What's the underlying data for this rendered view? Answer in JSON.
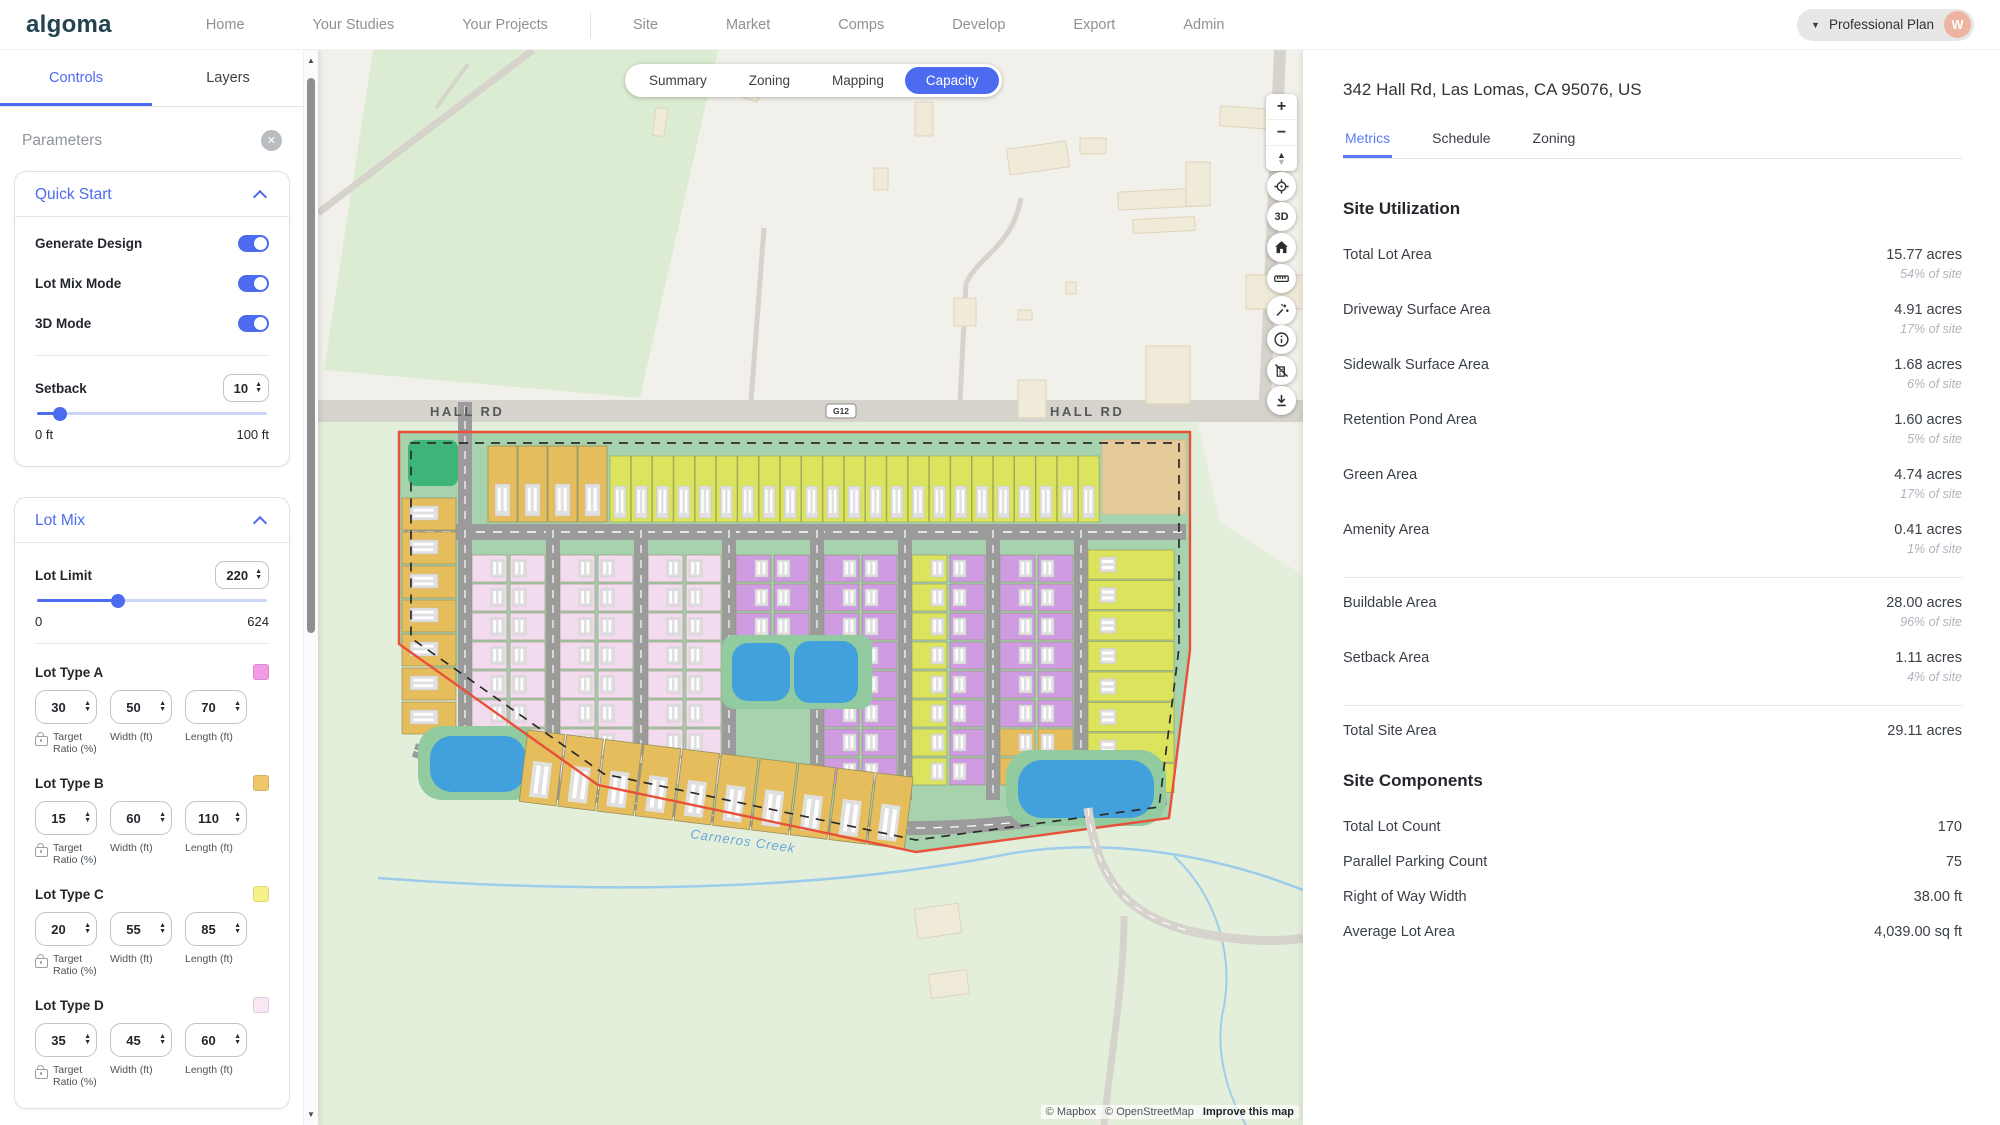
{
  "nav": {
    "logo": "algoma",
    "items": [
      "Home",
      "Your Studies",
      "Your Projects",
      "Site",
      "Market",
      "Comps",
      "Develop",
      "Export",
      "Admin"
    ],
    "plan": {
      "label": "Professional Plan",
      "avatar_initial": "W"
    }
  },
  "icons": {
    "close": "✕",
    "caret_down": "▼",
    "up": "▲",
    "down": "▼",
    "plus": "+",
    "minus": "−",
    "compass_up": "▲",
    "compass_down": "▼"
  },
  "sidebar": {
    "tabs": [
      {
        "label": "Controls",
        "active": true
      },
      {
        "label": "Layers",
        "active": false
      }
    ],
    "panel_title": "Parameters",
    "quick_start": {
      "title": "Quick Start",
      "toggles": [
        {
          "label": "Generate Design",
          "on": true
        },
        {
          "label": "Lot Mix Mode",
          "on": true
        },
        {
          "label": "3D Mode",
          "on": true
        }
      ],
      "setback": {
        "label": "Setback",
        "value": "10",
        "percent": 10,
        "min_label": "0 ft",
        "max_label": "100 ft"
      }
    },
    "lot_mix": {
      "title": "Lot Mix",
      "lot_limit": {
        "label": "Lot Limit",
        "value": "220",
        "percent": 35,
        "min_label": "0",
        "max_label": "624"
      },
      "field_labels": {
        "ratio": "Target Ratio (%)",
        "width": "Width (ft)",
        "length": "Length (ft)"
      },
      "lot_types": [
        {
          "name": "Lot Type A",
          "swatch": "#f49be7",
          "target_ratio": "30",
          "width": "50",
          "length": "70"
        },
        {
          "name": "Lot Type B",
          "swatch": "#eec76c",
          "target_ratio": "15",
          "width": "60",
          "length": "110"
        },
        {
          "name": "Lot Type C",
          "swatch": "#f5f287",
          "target_ratio": "20",
          "width": "55",
          "length": "85"
        },
        {
          "name": "Lot Type D",
          "swatch": "#f8e7f4",
          "target_ratio": "35",
          "width": "45",
          "length": "60"
        }
      ]
    }
  },
  "map": {
    "tabs": [
      {
        "label": "Summary",
        "active": false
      },
      {
        "label": "Zoning",
        "active": false
      },
      {
        "label": "Mapping",
        "active": false
      },
      {
        "label": "Capacity",
        "active": true
      }
    ],
    "labels": {
      "hall_rd_left": "HALL RD",
      "hall_rd_right": "HALL RD",
      "route_shield": "G12",
      "sill_rd": "SILL RD",
      "creek": "Carneros Creek"
    },
    "three_d": "3D",
    "attribution": {
      "mapbox": "© Mapbox",
      "openstreetmap": "© OpenStreetMap",
      "improve": "Improve this map"
    },
    "palette": {
      "base": "#f2f0ea",
      "field_green": "#dcecd2",
      "lower_green": "#e4efdb",
      "road": "#d6d3cc",
      "site_green": "#a6d2ae",
      "pond_pad": "#92cb9f",
      "pond": "#42a0dc",
      "amenity": "#3fb478",
      "tan": "#e5cb9a",
      "boundary_red": "#e8503a",
      "site_road": "#9b9b9b",
      "lot_a": "#cf9ce1",
      "lot_b": "#e5bd5c",
      "lot_c": "#dce45d",
      "lot_d": "#f3dbef",
      "house": "#e0e0e0",
      "building": "#f0ead9",
      "building_stroke": "#ddd4bc",
      "creek_blue": "#9ccdea",
      "creek_label": "#6aa6d8"
    }
  },
  "details": {
    "address": "342 Hall Rd, Las Lomas, CA 95076, US",
    "tabs": [
      {
        "label": "Metrics",
        "active": true
      },
      {
        "label": "Schedule",
        "active": false
      },
      {
        "label": "Zoning",
        "active": false
      }
    ],
    "site_utilization": {
      "title": "Site Utilization",
      "rows": [
        {
          "label": "Total Lot Area",
          "value": "15.77 acres",
          "sub": "54% of site"
        },
        {
          "label": "Driveway Surface Area",
          "value": "4.91 acres",
          "sub": "17% of site"
        },
        {
          "label": "Sidewalk Surface Area",
          "value": "1.68 acres",
          "sub": "6% of site"
        },
        {
          "label": "Retention Pond Area",
          "value": "1.60 acres",
          "sub": "5% of site"
        },
        {
          "label": "Green Area",
          "value": "4.74 acres",
          "sub": "17% of site"
        },
        {
          "label": "Amenity Area",
          "value": "0.41 acres",
          "sub": "1% of site"
        },
        {
          "label": "Buildable Area",
          "value": "28.00 acres",
          "sub": "96% of site"
        },
        {
          "label": "Setback Area",
          "value": "1.11 acres",
          "sub": "4% of site"
        },
        {
          "label": "Total Site Area",
          "value": "29.11 acres",
          "sub": ""
        }
      ]
    },
    "site_components": {
      "title": "Site Components",
      "rows": [
        {
          "label": "Total Lot Count",
          "value": "170"
        },
        {
          "label": "Parallel Parking Count",
          "value": "75"
        },
        {
          "label": "Right of Way Width",
          "value": "38.00 ft"
        },
        {
          "label": "Average Lot Area",
          "value": "4,039.00 sq ft"
        }
      ]
    }
  }
}
